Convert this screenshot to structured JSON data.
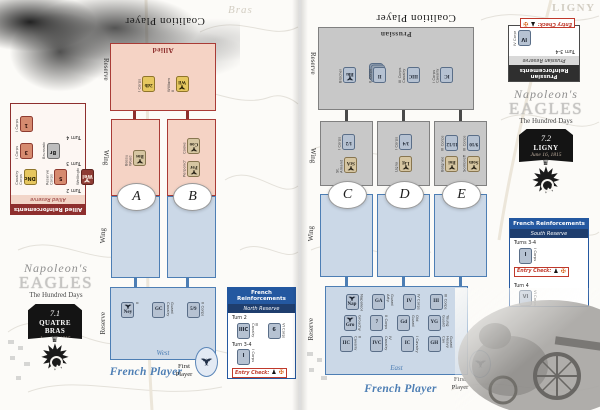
{
  "colors": {
    "coalition_red": "#8e2f2e",
    "french_blue": "#2458a0",
    "steel_blue": "#4d7eb4",
    "allied_pink": "#f5d3c5",
    "prussian_gray": "#c8c8c8",
    "zone_blue": "#cbd8e7",
    "entry_check_red": "#c0392b"
  },
  "pages": [
    {
      "map_label": "Bras",
      "logo": {
        "script": "Napoleon's",
        "title": "EAGLES",
        "subtitle": "The Hundred Days"
      },
      "scenario": {
        "number": "7.1",
        "name": "QUATRE BRAS",
        "date": "June 16, 1815"
      },
      "coalition": {
        "player_label": "Coalition Player",
        "zone_label": "Allied",
        "reserve_label": "Reserve",
        "wing_label": "Wing",
        "reserve_rows": [
          [
            {
              "text": "2db",
              "side": "I Corps",
              "color": "yellow"
            },
            {
              "text": "Wil",
              "side": "William II",
              "color": "yellow",
              "eagle": true
            }
          ]
        ],
        "wings": [
          {
            "letter": "A",
            "rows": [
              [
                {
                  "text": "Bos",
                  "side": "Bossu Wood",
                  "color": "tan",
                  "eagle": true
                }
              ]
            ]
          },
          {
            "letter": "B",
            "rows": [
              [
                {
                  "text": "Coo",
                  "side": "Cooke",
                  "color": "tan",
                  "eagle": true
                }
              ],
              [
                {
                  "text": "Per",
                  "side": "Perponcher",
                  "color": "tan",
                  "eagle": true
                }
              ]
            ]
          }
        ],
        "reinforcements": {
          "title": "Allied Reinforcements",
          "subtitle": "Allied Reserve",
          "groups": [
            {
              "turn": "Turn 2",
              "counters": [
                {
                  "text": "DNc",
                  "side": "Cavalry Corps",
                  "color": "yellow"
                },
                {
                  "text": "5",
                  "side": "Reserve Corps",
                  "color": "salmon"
                },
                {
                  "text": "Wel",
                  "side": "Wellington",
                  "color": "darkred",
                  "eagle": true
                }
              ]
            },
            {
              "turn": "Turn 3",
              "counters": [
                {
                  "text": "3",
                  "side": "I Corps",
                  "color": "salmon"
                },
                {
                  "text": "Br",
                  "side": "Brunswick",
                  "color": "gray"
                }
              ]
            },
            {
              "turn": "Turn 4",
              "counters": [
                {
                  "text": "1",
                  "side": "I Corps",
                  "color": "salmon"
                }
              ]
            }
          ]
        }
      },
      "french": {
        "player_label": "French Player",
        "first_player_label": "First Player",
        "wing_label": "Wing",
        "reserve_label": "Reserve",
        "direction_label": "West",
        "reserve_rows": [
          [
            {
              "text": "Ney",
              "side": "II",
              "color": "blue",
              "eagle": true
            },
            {
              "text": "GC",
              "side": "Guard Cavalry",
              "color": "blue"
            },
            {
              "text": "5/9",
              "side": "II Corps",
              "color": "blue"
            }
          ]
        ],
        "reinforcements": {
          "title": "French Reinforcements",
          "subtitle": "North Reserve",
          "entry_check_label": "Entry Check:",
          "groups": [
            {
              "turn": "Turn 2",
              "counters": [
                {
                  "text": "IIIC",
                  "side": "III Cavalry",
                  "color": "blue"
                },
                {
                  "text": "6",
                  "side": "VI Corps",
                  "color": "blue"
                }
              ]
            },
            {
              "turn": "Turn 3-4",
              "counters": [
                {
                  "text": "I",
                  "side": "I Corps",
                  "color": "blue"
                }
              ]
            }
          ]
        }
      }
    },
    {
      "map_label": "LIGNY",
      "logo": {
        "script": "Napoleon's",
        "title": "EAGLES",
        "subtitle": "The Hundred Days"
      },
      "scenario": {
        "number": "7.2",
        "name": "LIGNY",
        "date": "June 16, 1815"
      },
      "coalition": {
        "player_label": "Coalition Player",
        "zone_label": "Prussian",
        "reserve_label": "Reserve",
        "wing_label": "Wing",
        "reserve_rows": [
          [
            {
              "text": "Blu",
              "side": "Blücher",
              "color": "blue",
              "eagle": true
            },
            {
              "text": "II",
              "side": "II Corps",
              "color": "blue",
              "stack": true
            },
            {
              "text": "IIIC",
              "side": "III Corps Cavalry",
              "color": "blue"
            },
            {
              "text": "IC",
              "side": "I Corps Cavalry",
              "color": "blue"
            }
          ]
        ],
        "wings": [
          {
            "letter": "C",
            "rows": [
              [
                {
                  "text": "1/2",
                  "side": "I Corps",
                  "color": "blue"
                }
              ],
              [
                {
                  "text": "StA",
                  "side": "St. Amand",
                  "color": "tan",
                  "eagle": true
                }
              ]
            ]
          },
          {
            "letter": "D",
            "rows": [
              [
                {
                  "text": "3/4",
                  "side": "I Corps",
                  "color": "blue"
                }
              ],
              [
                {
                  "text": "Lig",
                  "side": "Ligny",
                  "color": "tan",
                  "eagle": true
                }
              ]
            ]
          },
          {
            "letter": "E",
            "rows": [
              [
                {
                  "text": "11/12",
                  "side": "III Corps",
                  "color": "blue"
                },
                {
                  "text": "9/10",
                  "side": "III Corps",
                  "color": "blue"
                }
              ],
              [
                {
                  "text": "Boi",
                  "side": "Boignée",
                  "color": "tan",
                  "eagle": true
                },
                {
                  "text": "Som",
                  "side": "Sombreffe",
                  "color": "tan",
                  "eagle": true
                }
              ]
            ]
          }
        ],
        "reinforcements": {
          "title": "Prussian Reinforcements",
          "subtitle": "Prussian Reserve",
          "entry_check_label": "Entry Check:",
          "groups": [
            {
              "turn": "Turn 3-4",
              "counters": [
                {
                  "text": "IV",
                  "side": "IV Corps",
                  "color": "blue"
                }
              ]
            }
          ]
        }
      },
      "french": {
        "player_label": "French Player",
        "first_player_label": "First Player",
        "wing_label": "Wing",
        "reserve_label": "Reserve",
        "direction_label": "East",
        "reserve_rows": [
          [
            {
              "text": "Nap",
              "side": "Napoleon",
              "color": "blue",
              "eagle": true
            },
            {
              "text": "GA",
              "side": "Guard Arty.",
              "color": "blue"
            },
            {
              "text": "IV",
              "side": "IV Corps",
              "color": "blue"
            },
            {
              "text": "III",
              "side": "III Corps",
              "color": "blue"
            }
          ],
          [
            {
              "text": "Gro",
              "side": "Grouchy",
              "color": "blue",
              "eagle": true
            },
            {
              "text": "7",
              "side": "II Corps",
              "color": "blue"
            },
            {
              "text": "Gd",
              "side": "Old Guard",
              "color": "blue"
            },
            {
              "text": "YG",
              "side": "Young Guard",
              "color": "blue"
            }
          ],
          [
            {
              "text": "IIC",
              "side": "II Cavalry",
              "color": "blue"
            },
            {
              "text": "IVC",
              "side": "IV Cavalry",
              "color": "blue"
            },
            {
              "text": "IC",
              "side": "I Cavalry",
              "color": "blue"
            },
            {
              "text": "GH",
              "side": "Guard Heavy Cav",
              "color": "blue"
            }
          ]
        ],
        "reinforcements": {
          "title": "French Reinforcements",
          "subtitle": "South Reserve",
          "entry_check_label": "Entry Check:",
          "groups": [
            {
              "turn": "Turns 3-4",
              "counters": [
                {
                  "text": "I",
                  "side": "I Corps",
                  "color": "blue"
                }
              ]
            },
            {
              "turn": "Turn 4",
              "counters": [
                {
                  "text": "VI",
                  "side": "VI Corps",
                  "color": "blue"
                }
              ]
            }
          ]
        }
      }
    }
  ]
}
